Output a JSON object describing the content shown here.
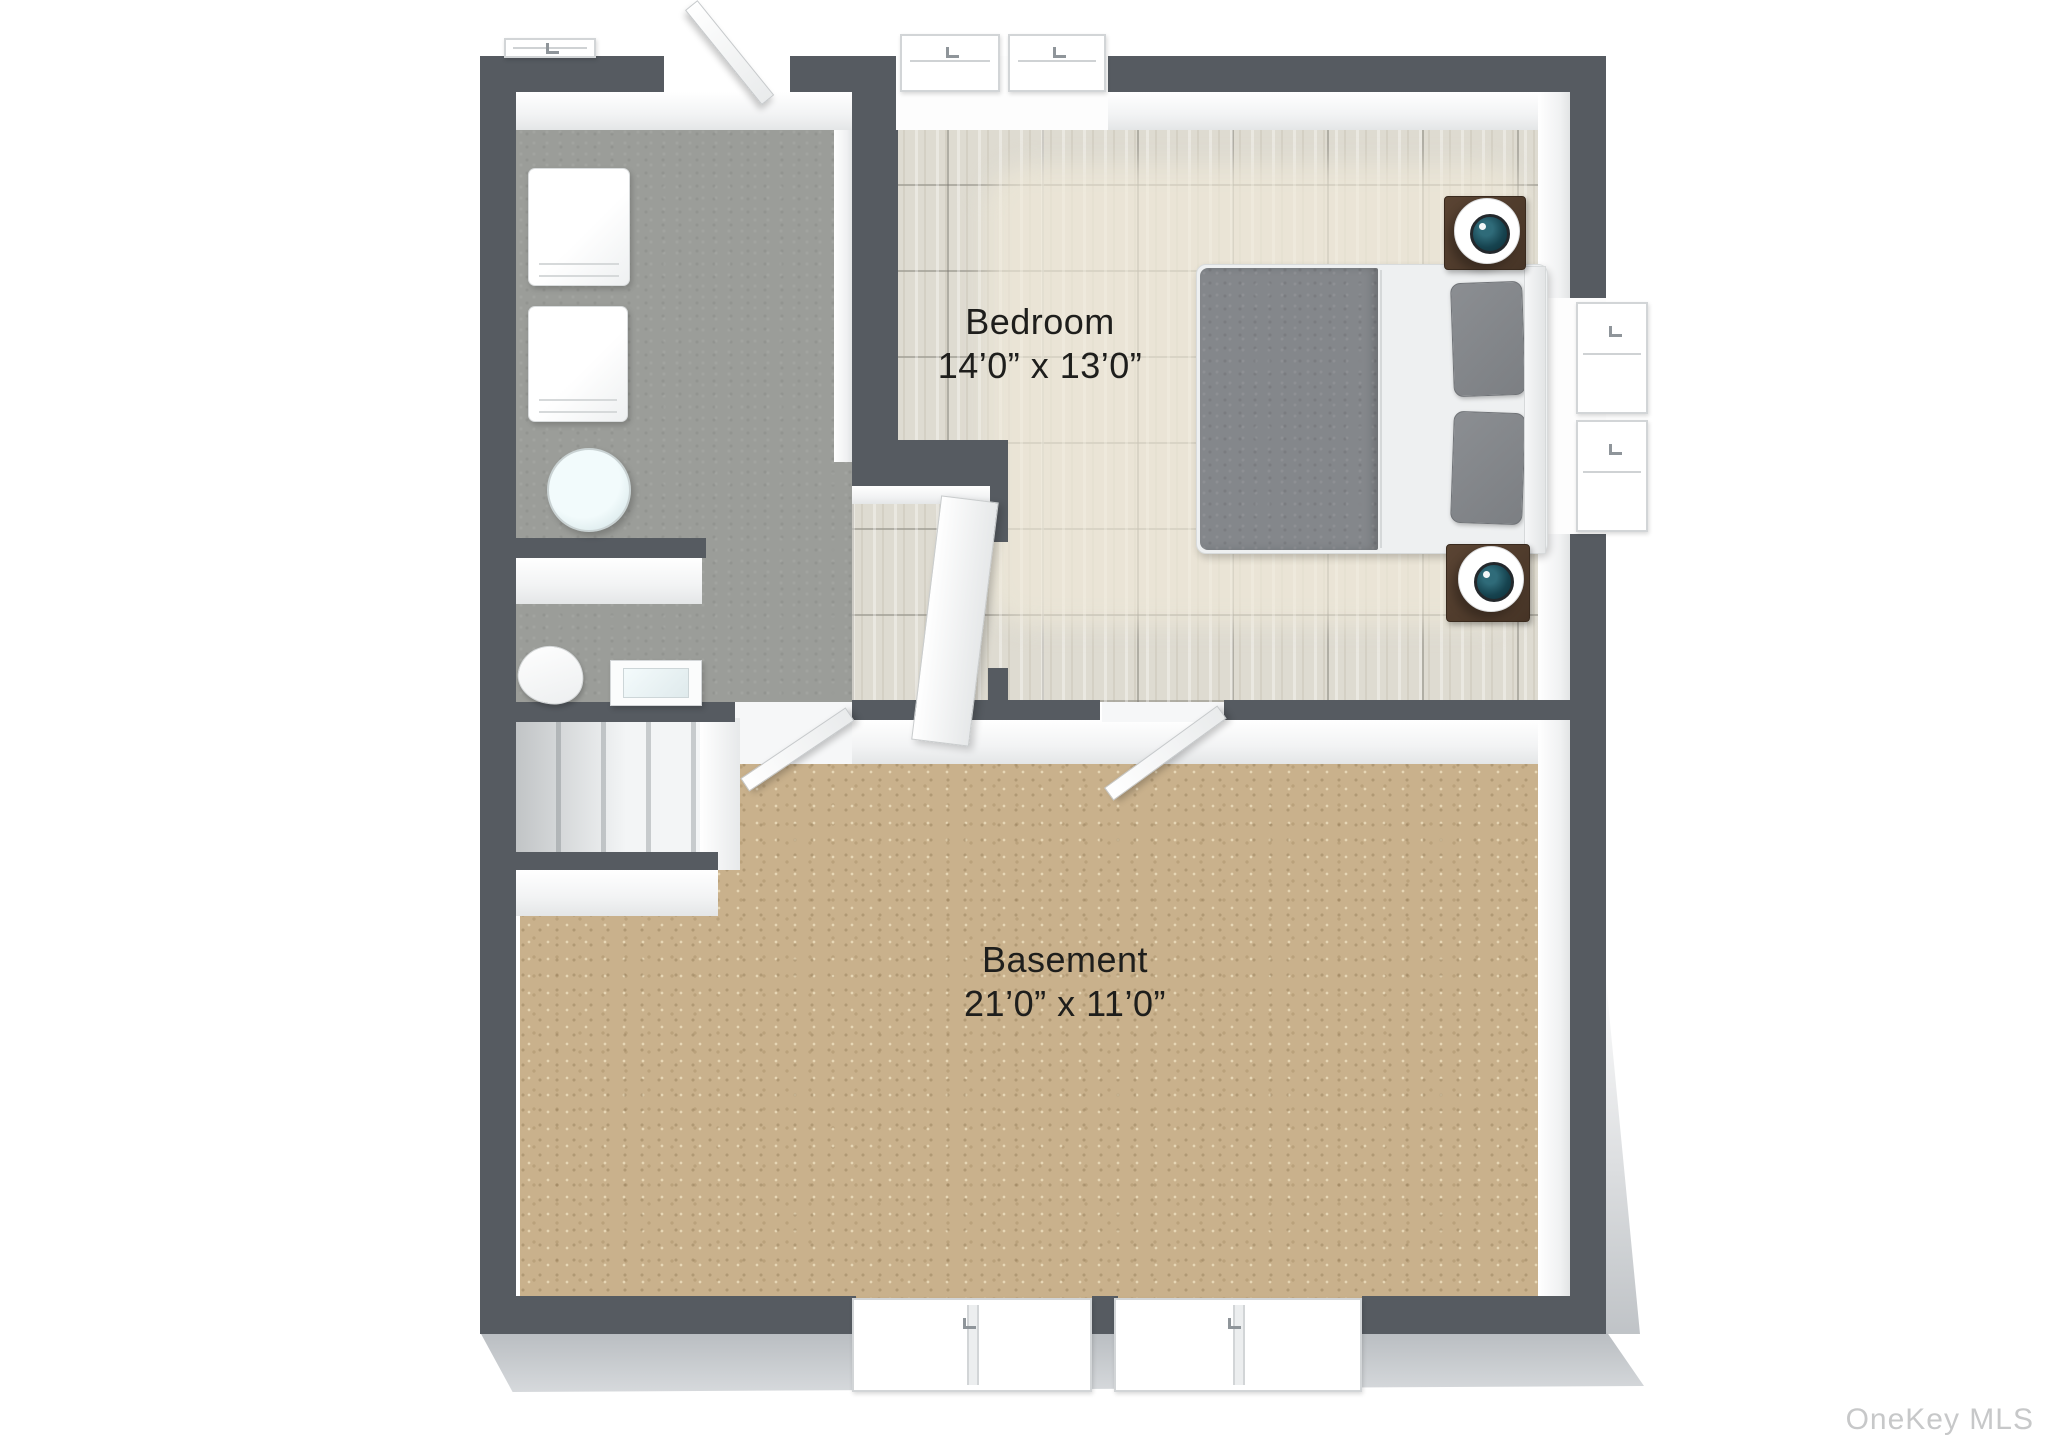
{
  "watermark": "OneKey MLS",
  "rooms": [
    {
      "id": "bedroom",
      "name": "Bedroom",
      "dimensions": "14’0” x 13’0”"
    },
    {
      "id": "basement",
      "name": "Basement",
      "dimensions": "21’0” x 11’0”"
    }
  ],
  "fixtures": [
    "washer",
    "dryer",
    "water-heater",
    "toilet",
    "sink-vanity",
    "staircase",
    "bed",
    "nightstand",
    "table-lamp",
    "sliding-closet-door",
    "hinged-door",
    "window"
  ],
  "colors": {
    "wall": "#565b61",
    "bathroom_floor": "#9b9d99",
    "bedroom_floor": "#dedbd1",
    "basement_carpet": "#c9b18c",
    "wall_face_white": "#f6f7f8",
    "nightstand_brown": "#4e3a2b",
    "lamp_center_teal": "#16434f",
    "bed_duvet_gray": "#84878b",
    "drop_shadow": "#c0c3c7",
    "label_text": "#1e1e1c",
    "watermark_text": "#c7c8c9"
  }
}
